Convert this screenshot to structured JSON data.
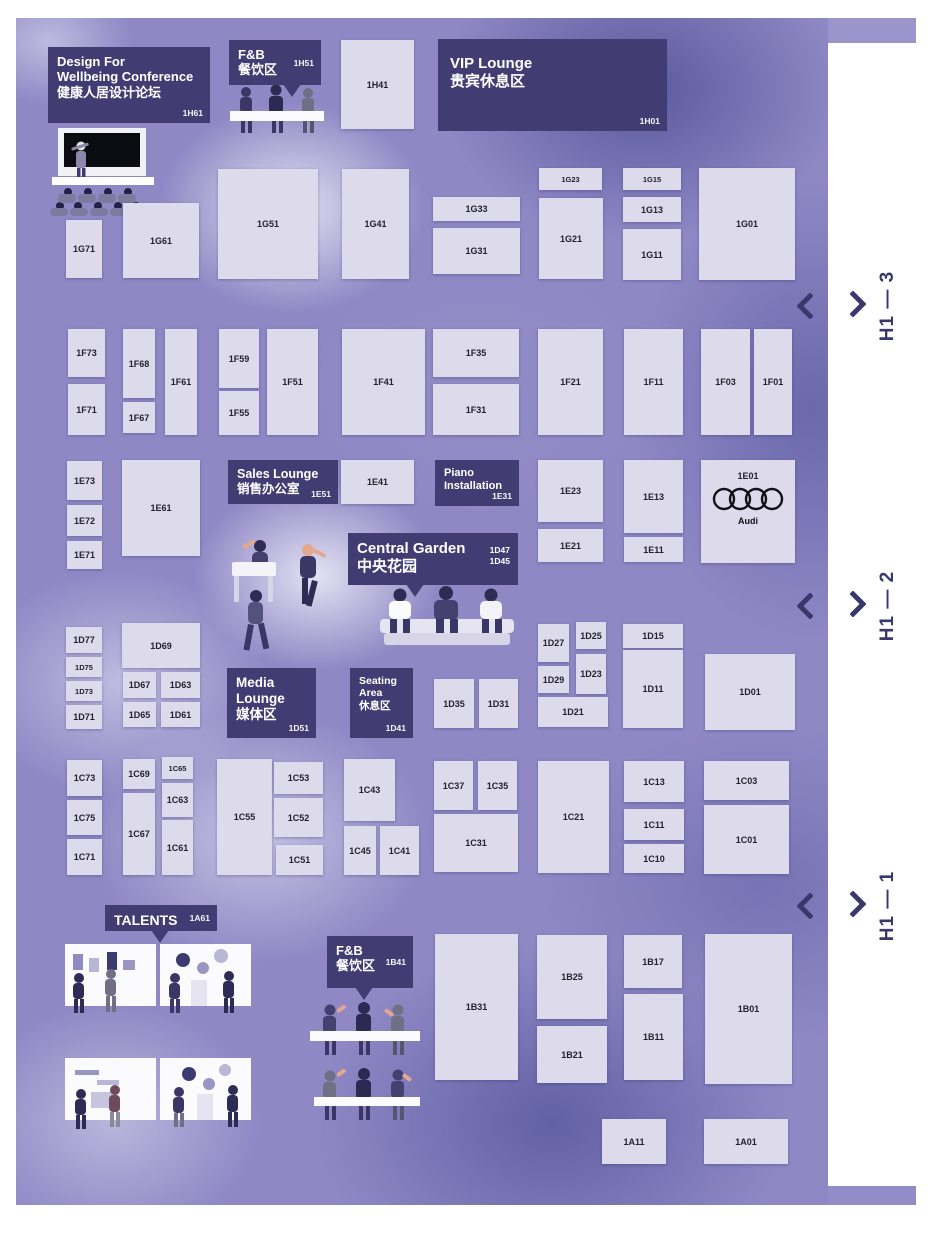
{
  "theme": {
    "banner_bg": "#413d72",
    "booth_bg": "#dcdaeb",
    "booth_text": "#23232e",
    "hall_label_color": "#3a376b",
    "map_bg": "#8f88c5"
  },
  "map": {
    "hall_labels": [
      {
        "id": "h1-3",
        "text": "H1 — 3",
        "y": 306
      },
      {
        "id": "h1-2",
        "text": "H1 — 2",
        "y": 606
      },
      {
        "id": "h1-1",
        "text": "H1 — 1",
        "y": 906
      }
    ],
    "areas": [
      {
        "id": "1H61",
        "name": "conference-area",
        "lines": [
          "Design For",
          "Wellbeing Conference",
          "健康人居设计论坛"
        ],
        "x": 48,
        "y": 47,
        "w": 162,
        "h": 76,
        "fs": 13
      },
      {
        "id": "1H51",
        "name": "fnb-north-area",
        "lines": [
          "F&B",
          "餐饮区"
        ],
        "x": 229,
        "y": 40,
        "w": 92,
        "h": 45,
        "fs": 13,
        "pointer": 54,
        "inlineId": true
      },
      {
        "id": "1H01",
        "name": "vip-lounge-area",
        "cls": "banner-vip",
        "lines": [
          "VIP Lounge",
          "贵宾休息区"
        ],
        "x": 438,
        "y": 39,
        "w": 229,
        "h": 92,
        "fs": 15
      },
      {
        "id": "1E51",
        "name": "sales-lounge-area",
        "lines": [
          "Sales Lounge",
          "销售办公室"
        ],
        "x": 228,
        "y": 460,
        "w": 110,
        "h": 44,
        "fs": 12.5
      },
      {
        "id": "1E31",
        "name": "piano-installation-area",
        "lines": [
          "Piano",
          "Installation"
        ],
        "x": 435,
        "y": 460,
        "w": 84,
        "h": 46,
        "fs": 11
      },
      {
        "ids": [
          "1D47",
          "1D45"
        ],
        "name": "central-garden-area",
        "lines": [
          "Central Garden",
          "中央花园"
        ],
        "x": 348,
        "y": 533,
        "w": 170,
        "h": 52,
        "fs": 15,
        "pointer": 58
      },
      {
        "id": "1D51",
        "name": "media-lounge-area",
        "lines": [
          "Media",
          "Lounge",
          "媒体区"
        ],
        "x": 227,
        "y": 668,
        "w": 89,
        "h": 70,
        "fs": 13.5
      },
      {
        "id": "1D41",
        "name": "seating-area",
        "lines": [
          "Seating",
          "Area",
          "休息区"
        ],
        "x": 350,
        "y": 668,
        "w": 63,
        "h": 70,
        "fs": 10.5
      },
      {
        "id": "1A61",
        "name": "talents-area",
        "lines": [
          "TALENTS"
        ],
        "x": 105,
        "y": 905,
        "w": 112,
        "h": 26,
        "fs": 14,
        "pointer": 46,
        "inlineId": true
      },
      {
        "id": "1B41",
        "name": "fnb-south-area",
        "lines": [
          "F&B",
          "餐饮区"
        ],
        "x": 327,
        "y": 936,
        "w": 86,
        "h": 52,
        "fs": 13,
        "pointer": 28,
        "inlineId": true
      }
    ],
    "booths": [
      {
        "id": "1H41",
        "x": 341,
        "y": 40,
        "w": 73,
        "h": 89
      },
      {
        "id": "1G71",
        "x": 66,
        "y": 220,
        "w": 36,
        "h": 58
      },
      {
        "id": "1G61",
        "x": 123,
        "y": 203,
        "w": 76,
        "h": 75
      },
      {
        "id": "1G51",
        "x": 218,
        "y": 169,
        "w": 100,
        "h": 110
      },
      {
        "id": "1G41",
        "x": 342,
        "y": 169,
        "w": 67,
        "h": 110
      },
      {
        "id": "1G33",
        "x": 433,
        "y": 197,
        "w": 87,
        "h": 24
      },
      {
        "id": "1G31",
        "x": 433,
        "y": 228,
        "w": 87,
        "h": 46
      },
      {
        "id": "1G23",
        "x": 539,
        "y": 168,
        "w": 63,
        "h": 22
      },
      {
        "id": "1G21",
        "x": 539,
        "y": 198,
        "w": 64,
        "h": 81
      },
      {
        "id": "1G15",
        "x": 623,
        "y": 168,
        "w": 58,
        "h": 22
      },
      {
        "id": "1G13",
        "x": 623,
        "y": 197,
        "w": 58,
        "h": 25
      },
      {
        "id": "1G11",
        "x": 623,
        "y": 229,
        "w": 58,
        "h": 51
      },
      {
        "id": "1G01",
        "x": 699,
        "y": 168,
        "w": 96,
        "h": 112
      },
      {
        "id": "1F73",
        "x": 68,
        "y": 329,
        "w": 37,
        "h": 48
      },
      {
        "id": "1F71",
        "x": 68,
        "y": 384,
        "w": 37,
        "h": 51
      },
      {
        "id": "1F68",
        "x": 123,
        "y": 329,
        "w": 32,
        "h": 69
      },
      {
        "id": "1F67",
        "x": 123,
        "y": 402,
        "w": 32,
        "h": 31
      },
      {
        "id": "1F61",
        "x": 165,
        "y": 329,
        "w": 32,
        "h": 106
      },
      {
        "id": "1F59",
        "x": 219,
        "y": 329,
        "w": 40,
        "h": 59
      },
      {
        "id": "1F55",
        "x": 219,
        "y": 391,
        "w": 40,
        "h": 44
      },
      {
        "id": "1F51",
        "x": 267,
        "y": 329,
        "w": 51,
        "h": 106
      },
      {
        "id": "1F41",
        "x": 342,
        "y": 329,
        "w": 83,
        "h": 106
      },
      {
        "id": "1F35",
        "x": 433,
        "y": 329,
        "w": 86,
        "h": 48
      },
      {
        "id": "1F31",
        "x": 433,
        "y": 384,
        "w": 86,
        "h": 51
      },
      {
        "id": "1F21",
        "x": 538,
        "y": 329,
        "w": 65,
        "h": 106
      },
      {
        "id": "1F11",
        "x": 624,
        "y": 329,
        "w": 59,
        "h": 106
      },
      {
        "id": "1F03",
        "x": 701,
        "y": 329,
        "w": 49,
        "h": 106
      },
      {
        "id": "1F01",
        "x": 754,
        "y": 329,
        "w": 38,
        "h": 106
      },
      {
        "id": "1E73",
        "x": 67,
        "y": 461,
        "w": 35,
        "h": 39
      },
      {
        "id": "1E72",
        "x": 67,
        "y": 505,
        "w": 35,
        "h": 31
      },
      {
        "id": "1E71",
        "x": 67,
        "y": 541,
        "w": 35,
        "h": 28
      },
      {
        "id": "1E61",
        "x": 122,
        "y": 460,
        "w": 78,
        "h": 96
      },
      {
        "id": "1E41",
        "x": 341,
        "y": 460,
        "w": 73,
        "h": 44
      },
      {
        "id": "1E23",
        "x": 538,
        "y": 460,
        "w": 65,
        "h": 62
      },
      {
        "id": "1E21",
        "x": 538,
        "y": 529,
        "w": 65,
        "h": 33
      },
      {
        "id": "1E13",
        "x": 624,
        "y": 460,
        "w": 59,
        "h": 73
      },
      {
        "id": "1E11",
        "x": 624,
        "y": 537,
        "w": 59,
        "h": 25
      },
      {
        "id": "1E01",
        "x": 701,
        "y": 460,
        "w": 94,
        "h": 103,
        "logo": "audi"
      },
      {
        "id": "1D77",
        "x": 66,
        "y": 627,
        "w": 36,
        "h": 26
      },
      {
        "id": "1D75",
        "x": 66,
        "y": 657,
        "w": 36,
        "h": 20
      },
      {
        "id": "1D73",
        "x": 66,
        "y": 681,
        "w": 36,
        "h": 20
      },
      {
        "id": "1D71",
        "x": 66,
        "y": 705,
        "w": 36,
        "h": 24
      },
      {
        "id": "1D69",
        "x": 122,
        "y": 623,
        "w": 78,
        "h": 45
      },
      {
        "id": "1D67",
        "x": 123,
        "y": 672,
        "w": 33,
        "h": 26
      },
      {
        "id": "1D65",
        "x": 123,
        "y": 702,
        "w": 33,
        "h": 25
      },
      {
        "id": "1D63",
        "x": 161,
        "y": 672,
        "w": 39,
        "h": 26
      },
      {
        "id": "1D61",
        "x": 161,
        "y": 702,
        "w": 39,
        "h": 25
      },
      {
        "id": "1D35",
        "x": 434,
        "y": 679,
        "w": 40,
        "h": 49
      },
      {
        "id": "1D31",
        "x": 479,
        "y": 679,
        "w": 39,
        "h": 49
      },
      {
        "id": "1D27",
        "x": 538,
        "y": 624,
        "w": 31,
        "h": 38
      },
      {
        "id": "1D29",
        "x": 538,
        "y": 666,
        "w": 31,
        "h": 27
      },
      {
        "id": "1D25",
        "x": 576,
        "y": 622,
        "w": 30,
        "h": 27
      },
      {
        "id": "1D23",
        "x": 576,
        "y": 654,
        "w": 30,
        "h": 40
      },
      {
        "id": "1D21",
        "x": 538,
        "y": 697,
        "w": 70,
        "h": 30
      },
      {
        "id": "1D15",
        "x": 623,
        "y": 624,
        "w": 60,
        "h": 24
      },
      {
        "id": "1D11",
        "x": 623,
        "y": 650,
        "w": 60,
        "h": 78
      },
      {
        "id": "1D01",
        "x": 705,
        "y": 654,
        "w": 90,
        "h": 76
      },
      {
        "id": "1C73",
        "x": 67,
        "y": 760,
        "w": 35,
        "h": 36
      },
      {
        "id": "1C75",
        "x": 67,
        "y": 800,
        "w": 35,
        "h": 35
      },
      {
        "id": "1C71",
        "x": 67,
        "y": 839,
        "w": 35,
        "h": 36
      },
      {
        "id": "1C69",
        "x": 123,
        "y": 759,
        "w": 32,
        "h": 30
      },
      {
        "id": "1C67",
        "x": 123,
        "y": 793,
        "w": 32,
        "h": 82
      },
      {
        "id": "1C65",
        "x": 162,
        "y": 757,
        "w": 31,
        "h": 22
      },
      {
        "id": "1C63",
        "x": 162,
        "y": 783,
        "w": 31,
        "h": 34
      },
      {
        "id": "1C61",
        "x": 162,
        "y": 820,
        "w": 31,
        "h": 55
      },
      {
        "id": "1C55",
        "x": 217,
        "y": 759,
        "w": 55,
        "h": 116
      },
      {
        "id": "1C53",
        "x": 274,
        "y": 762,
        "w": 49,
        "h": 32
      },
      {
        "id": "1C52",
        "x": 274,
        "y": 798,
        "w": 49,
        "h": 39
      },
      {
        "id": "1C51",
        "x": 276,
        "y": 845,
        "w": 47,
        "h": 30
      },
      {
        "id": "1C43",
        "x": 344,
        "y": 759,
        "w": 51,
        "h": 62
      },
      {
        "id": "1C45",
        "x": 344,
        "y": 826,
        "w": 32,
        "h": 49
      },
      {
        "id": "1C41",
        "x": 380,
        "y": 826,
        "w": 39,
        "h": 49
      },
      {
        "id": "1C37",
        "x": 434,
        "y": 761,
        "w": 39,
        "h": 49
      },
      {
        "id": "1C35",
        "x": 478,
        "y": 761,
        "w": 39,
        "h": 49
      },
      {
        "id": "1C31",
        "x": 434,
        "y": 814,
        "w": 84,
        "h": 58
      },
      {
        "id": "1C21",
        "x": 538,
        "y": 761,
        "w": 71,
        "h": 112
      },
      {
        "id": "1C13",
        "x": 624,
        "y": 761,
        "w": 60,
        "h": 41
      },
      {
        "id": "1C11",
        "x": 624,
        "y": 809,
        "w": 60,
        "h": 31
      },
      {
        "id": "1C10",
        "x": 624,
        "y": 844,
        "w": 60,
        "h": 29
      },
      {
        "id": "1C03",
        "x": 704,
        "y": 761,
        "w": 85,
        "h": 39
      },
      {
        "id": "1C01",
        "x": 704,
        "y": 805,
        "w": 85,
        "h": 69
      },
      {
        "id": "1B31",
        "x": 435,
        "y": 934,
        "w": 83,
        "h": 146
      },
      {
        "id": "1B25",
        "x": 537,
        "y": 935,
        "w": 70,
        "h": 84
      },
      {
        "id": "1B21",
        "x": 537,
        "y": 1026,
        "w": 70,
        "h": 57
      },
      {
        "id": "1B17",
        "x": 624,
        "y": 935,
        "w": 58,
        "h": 53
      },
      {
        "id": "1B11",
        "x": 624,
        "y": 994,
        "w": 59,
        "h": 86
      },
      {
        "id": "1B01",
        "x": 705,
        "y": 934,
        "w": 87,
        "h": 150
      },
      {
        "id": "1A11",
        "x": 602,
        "y": 1119,
        "w": 64,
        "h": 45
      },
      {
        "id": "1A01",
        "x": 704,
        "y": 1119,
        "w": 84,
        "h": 45
      }
    ],
    "audi_logo_text": "Audi"
  }
}
